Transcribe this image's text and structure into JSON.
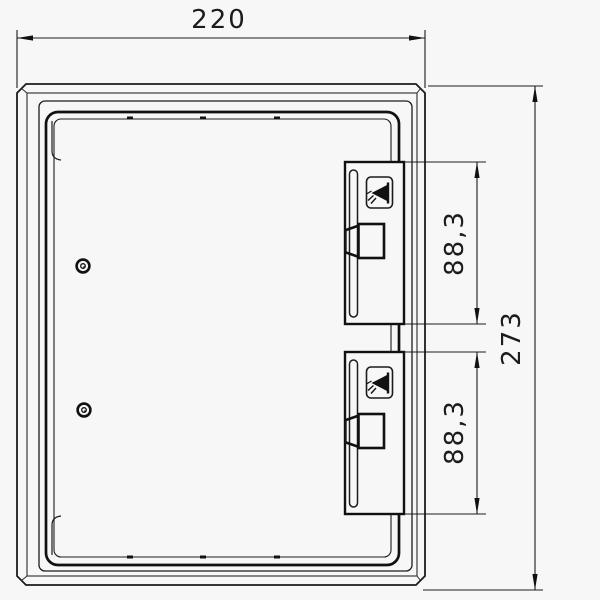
{
  "drawing_type": "technical-dimension-drawing",
  "dimensions": {
    "overall_width": "220",
    "overall_height": "273",
    "upper_latch_height": "88,3",
    "lower_latch_height": "88,3"
  },
  "icons": {
    "latch_icon": "press-indicator-icon",
    "screw_icon": "screw-head-icon"
  },
  "colors": {
    "line": "#1c1c1c",
    "background": "#f7f7f7"
  }
}
